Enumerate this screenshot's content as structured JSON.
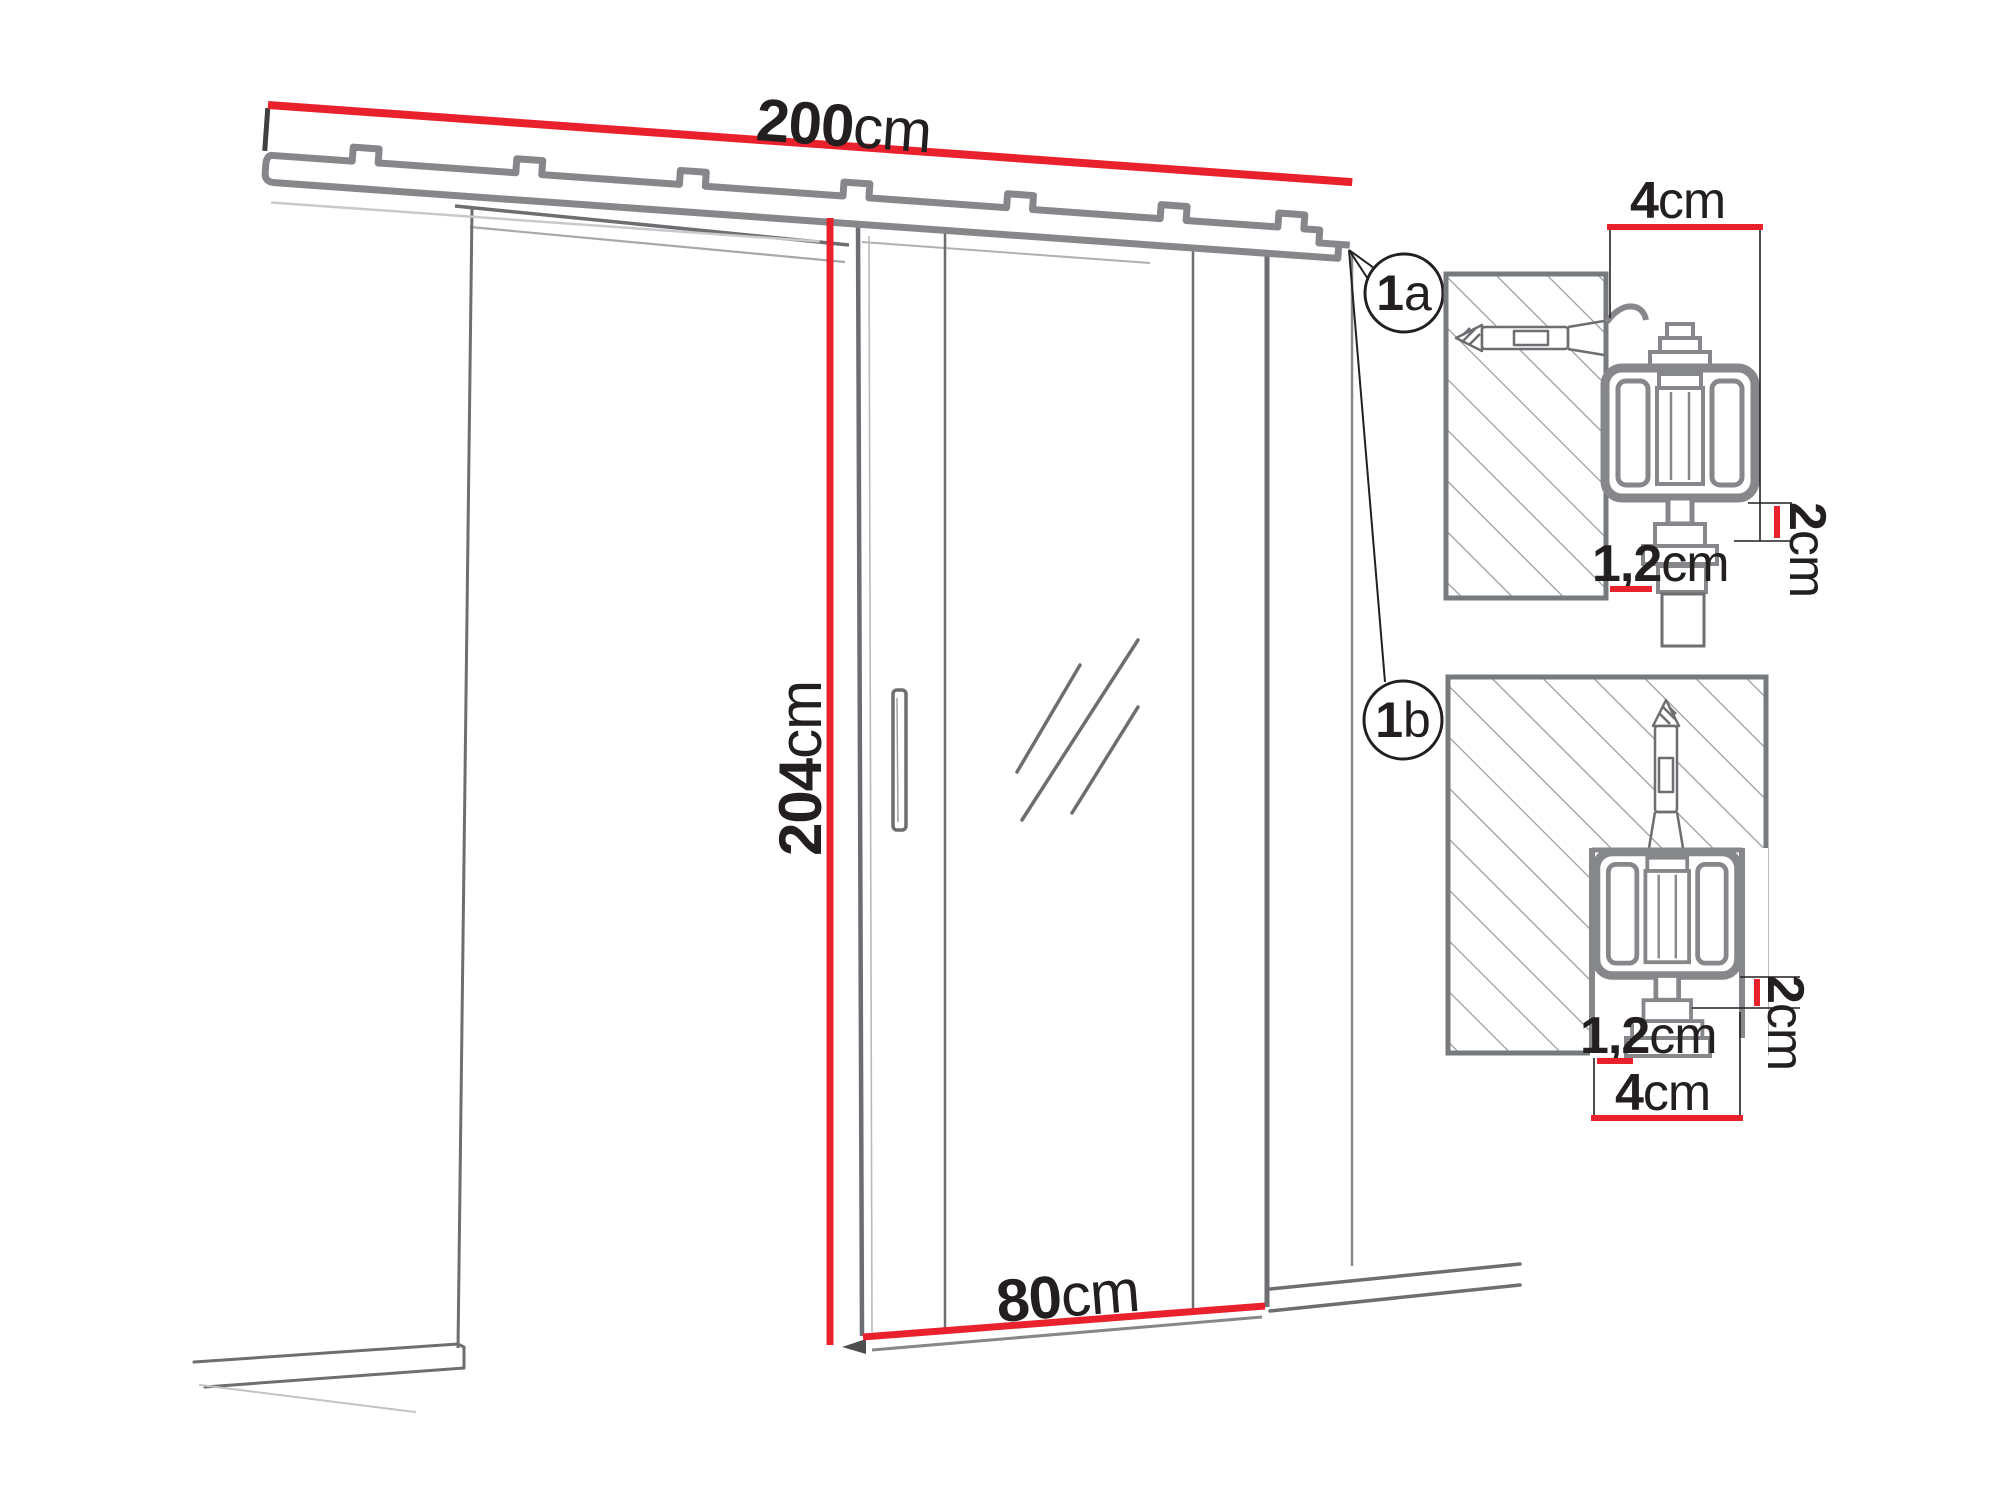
{
  "diagram": {
    "kind": "sliding-door-mounting-dimensions",
    "dimensions": {
      "track_length": {
        "num": "200",
        "unit": "cm"
      },
      "door_height": {
        "num": "204",
        "unit": "cm"
      },
      "door_width": {
        "num": "80",
        "unit": "cm"
      }
    },
    "callouts": {
      "a": {
        "num": "1",
        "letter": "a"
      },
      "b": {
        "num": "1",
        "letter": "b"
      }
    },
    "detail_a": {
      "track_depth": {
        "num": "4",
        "unit": "cm"
      },
      "clearance": {
        "num": "2",
        "unit": "cm"
      },
      "gap": {
        "num": "1,2",
        "unit": "cm"
      }
    },
    "detail_b": {
      "track_width": {
        "num": "4",
        "unit": "cm"
      },
      "clearance": {
        "num": "2",
        "unit": "cm"
      },
      "gap": {
        "num": "1,2",
        "unit": "cm"
      }
    },
    "colors": {
      "dimension_red": "#e8212d",
      "outline_gray": "#6d6e71",
      "profile_gray": "#85878a",
      "hatch_gray": "#9a9b9d",
      "text_black": "#231f20"
    }
  }
}
